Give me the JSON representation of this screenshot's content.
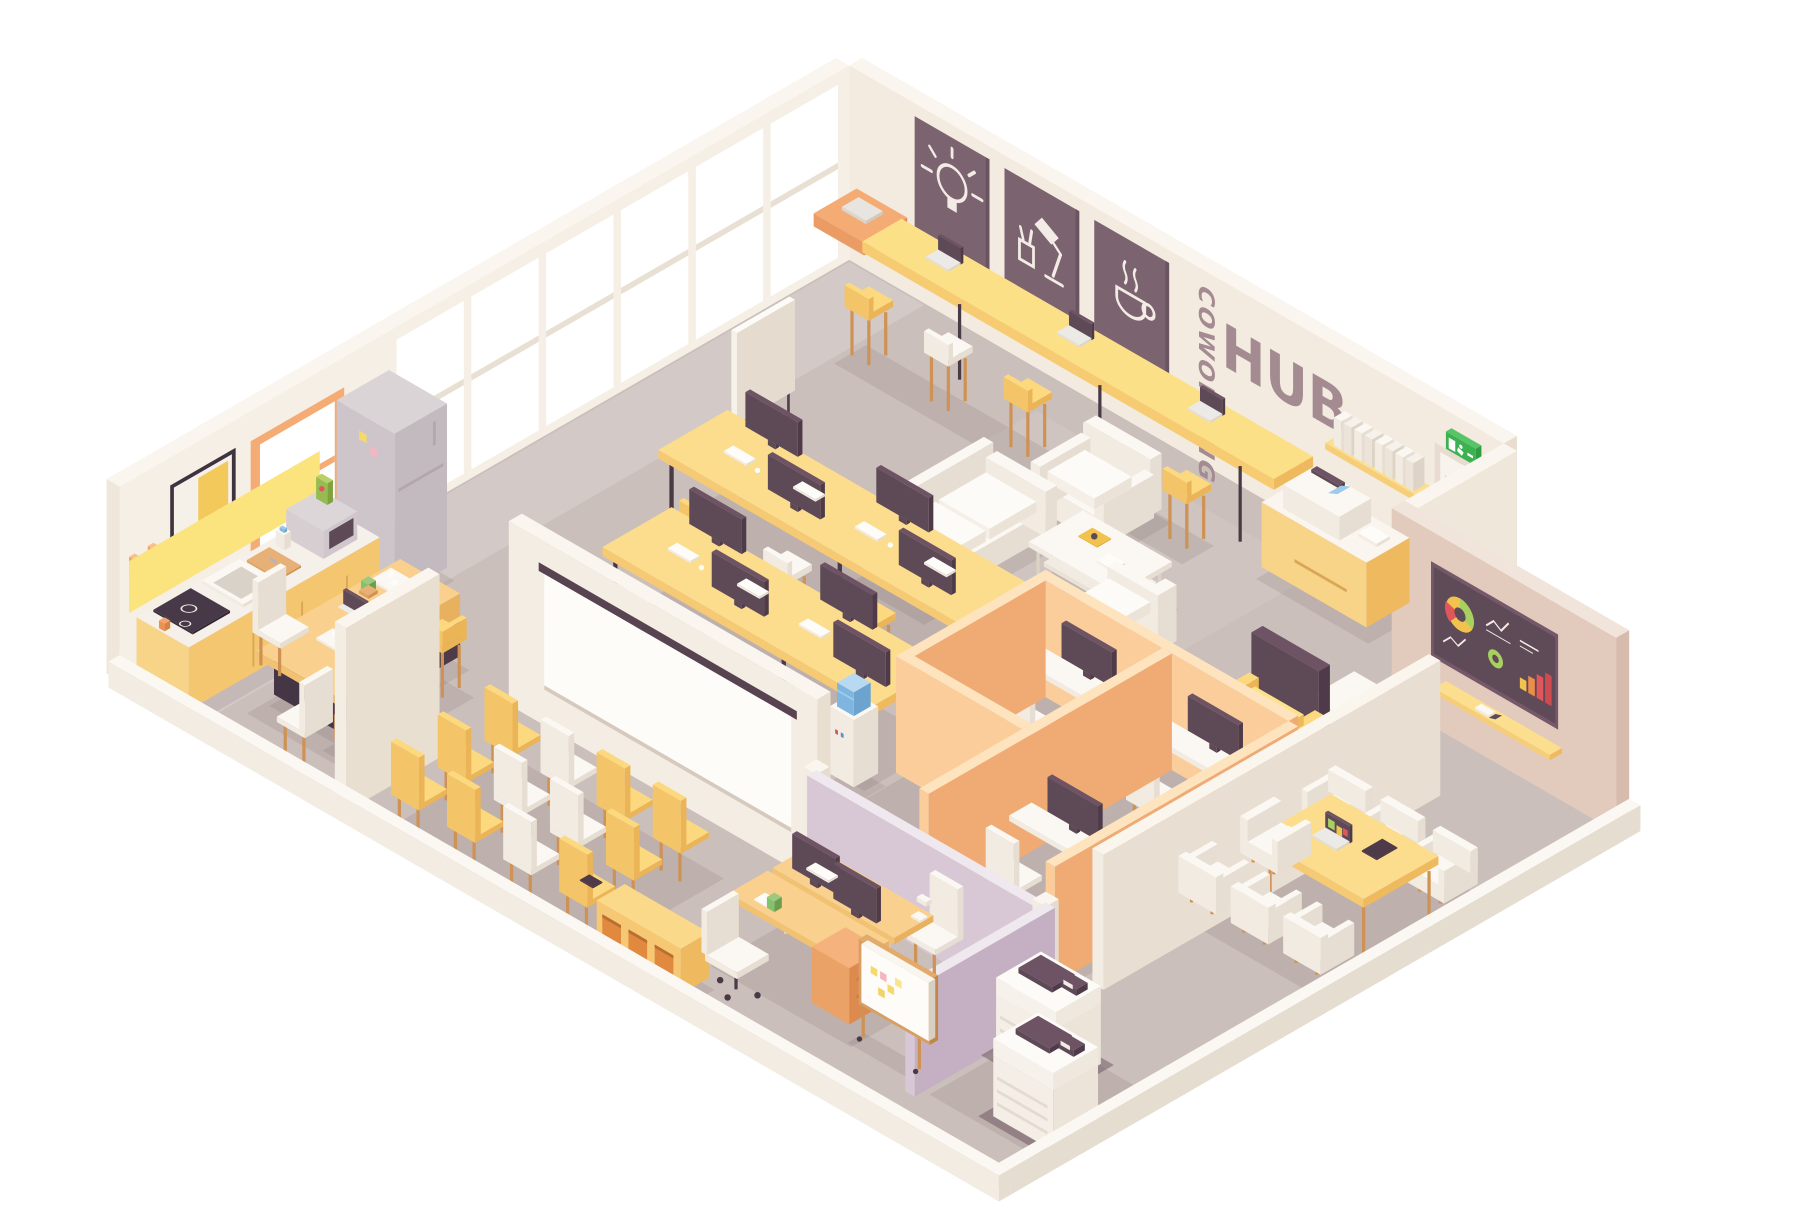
{
  "scene_title": "Isometric coworking hub interior cutaway",
  "signage": {
    "coworking": "COWORKING",
    "hub": "HUB",
    "color": "#a48b92"
  },
  "wall_posters": {
    "count": 3,
    "background": "#7c6370",
    "icon_color": "#f3ece6",
    "items": [
      {
        "icon": "lightbulb-icon"
      },
      {
        "icon": "desk-lamp-icon"
      },
      {
        "icon": "coffee-cup-icon"
      }
    ]
  },
  "exit_sign": {
    "color": "#3cb14f",
    "pictogram": "running-man-and-door"
  },
  "tv_dashboard": {
    "screen_color": "#5f4a57",
    "charts": [
      {
        "type": "pie",
        "slices": [
          {
            "color": "#a8d05e",
            "value": 35
          },
          {
            "color": "#f2c24e",
            "value": 40
          },
          {
            "color": "#e0565a",
            "value": 25
          }
        ]
      },
      {
        "type": "line",
        "color": "#f3ece6"
      },
      {
        "type": "donut",
        "colors": [
          "#a8d05e",
          "#44584a"
        ]
      },
      {
        "type": "bar",
        "values": [
          10,
          16,
          22,
          28
        ],
        "colors": [
          "#f2c24e",
          "#ee8c4a",
          "#e0565a",
          "#cf4b50"
        ]
      },
      {
        "type": "line",
        "color": "#f3ece6"
      }
    ]
  },
  "palette": {
    "floor": "#cbbfbb",
    "floor_shadow": "rgba(93,71,77,0.12)",
    "wall_top": "#faf6ef",
    "wall_ne_face": "#f3ebdf",
    "wall_nw_face": "#f5efe6",
    "pink_wall_face": "#e2cabc",
    "backsplash": "#fbe37e",
    "accent_yellow": "#fcdd8d",
    "accent_orange": "#f5ab74",
    "wood": "#cf9255",
    "dark_plum": "#5d4a56",
    "purple_partition": "#d8c8d5",
    "cubicle_orange": "#fbcd9b",
    "exit_green": "#3cb14f",
    "cooler_blue": "#7fb6e0",
    "glass": "#ffffff"
  },
  "inventory": {
    "window_wall": {
      "glass_panes": 6,
      "orange_window": 1,
      "art_print": 1,
      "coat_hooks": 2
    },
    "laptop_bar": {
      "open_laptops": 3,
      "closed_laptops": 1,
      "bar_stools": 5
    },
    "wall_shelf_binders": 8,
    "kitchen": [
      "fridge",
      "microwave",
      "cereal-box",
      "milk-carton",
      "cutting-board",
      "sink",
      "stove",
      "cabinets",
      "mug"
    ],
    "kitchen_island": {
      "stools": 3,
      "laptop": 1,
      "cactus": 1
    },
    "dining_table_chairs": 2,
    "lounge": {
      "sofa": 1,
      "armchairs": 2,
      "coffee_table": 1,
      "magazine": 1,
      "book": 1,
      "flipchart": 1
    },
    "hot_desks": {
      "desks": 2,
      "monitors": 8,
      "keyboards": 8,
      "stools": 6
    },
    "cubicles": {
      "cells": 3,
      "monitors": 3,
      "chairs": 3
    },
    "water_cooler": 1,
    "accent_armchair": 1,
    "laptop_side_table": 1,
    "side_table": 1,
    "printer_station": {
      "printer": 1,
      "cabinet": 1
    },
    "conference_room": {
      "table": 1,
      "tub_chairs": 7,
      "laptop": 1,
      "tablet": 1,
      "tv": 1,
      "wall_shelf": 1
    },
    "copy_room_copiers": 2,
    "presentation_room": {
      "projection_screen": 1,
      "chairs": 12,
      "tablet": 1,
      "shelf_unit": 1
    },
    "private_office": {
      "desks": 2,
      "monitors": 2,
      "chairs": 2,
      "whiteboard": 1,
      "desk_lamp": 1,
      "cactus": 1
    }
  }
}
